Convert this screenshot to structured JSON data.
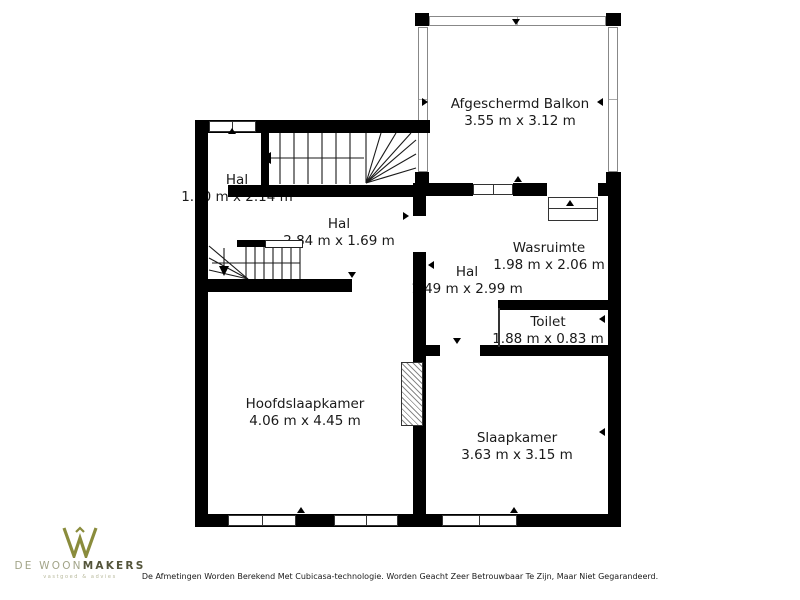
{
  "floorplan": {
    "wall_color": "#000000",
    "rooms": [
      {
        "id": "afgeschermd-balkon",
        "label": "Afgeschermd Balkon",
        "dims": "3.55 m x 3.12 m"
      },
      {
        "id": "hal-boven",
        "label": "Hal",
        "dims": "1.10 m x 2.14 m"
      },
      {
        "id": "hal-midden",
        "label": "Hal",
        "dims": "2.84 m x 1.69 m"
      },
      {
        "id": "hal-centraal",
        "label": "Hal",
        "dims": "1.49 m x 2.99 m"
      },
      {
        "id": "wasruimte",
        "label": "Wasruimte",
        "dims": "1.98 m x 2.06 m"
      },
      {
        "id": "toilet",
        "label": "Toilet",
        "dims": "1.88 m x 0.83 m"
      },
      {
        "id": "hoofdslaapkamer",
        "label": "Hoofdslaapkamer",
        "dims": "4.06 m x 4.45 m"
      },
      {
        "id": "slaapkamer",
        "label": "Slaapkamer",
        "dims": "3.63 m x 3.15 m"
      }
    ]
  },
  "footer": {
    "logo": {
      "brand_prefix": "DE WOON",
      "brand_suffix": "MAKERS",
      "tagline": "vastgoed & advies",
      "accent_color": "#8a8c3c"
    },
    "disclaimer": "De Afmetingen Worden Berekend Met Cubicasa-technologie. Worden Geacht Zeer Betrouwbaar Te Zijn, Maar Niet Gegarandeerd."
  }
}
